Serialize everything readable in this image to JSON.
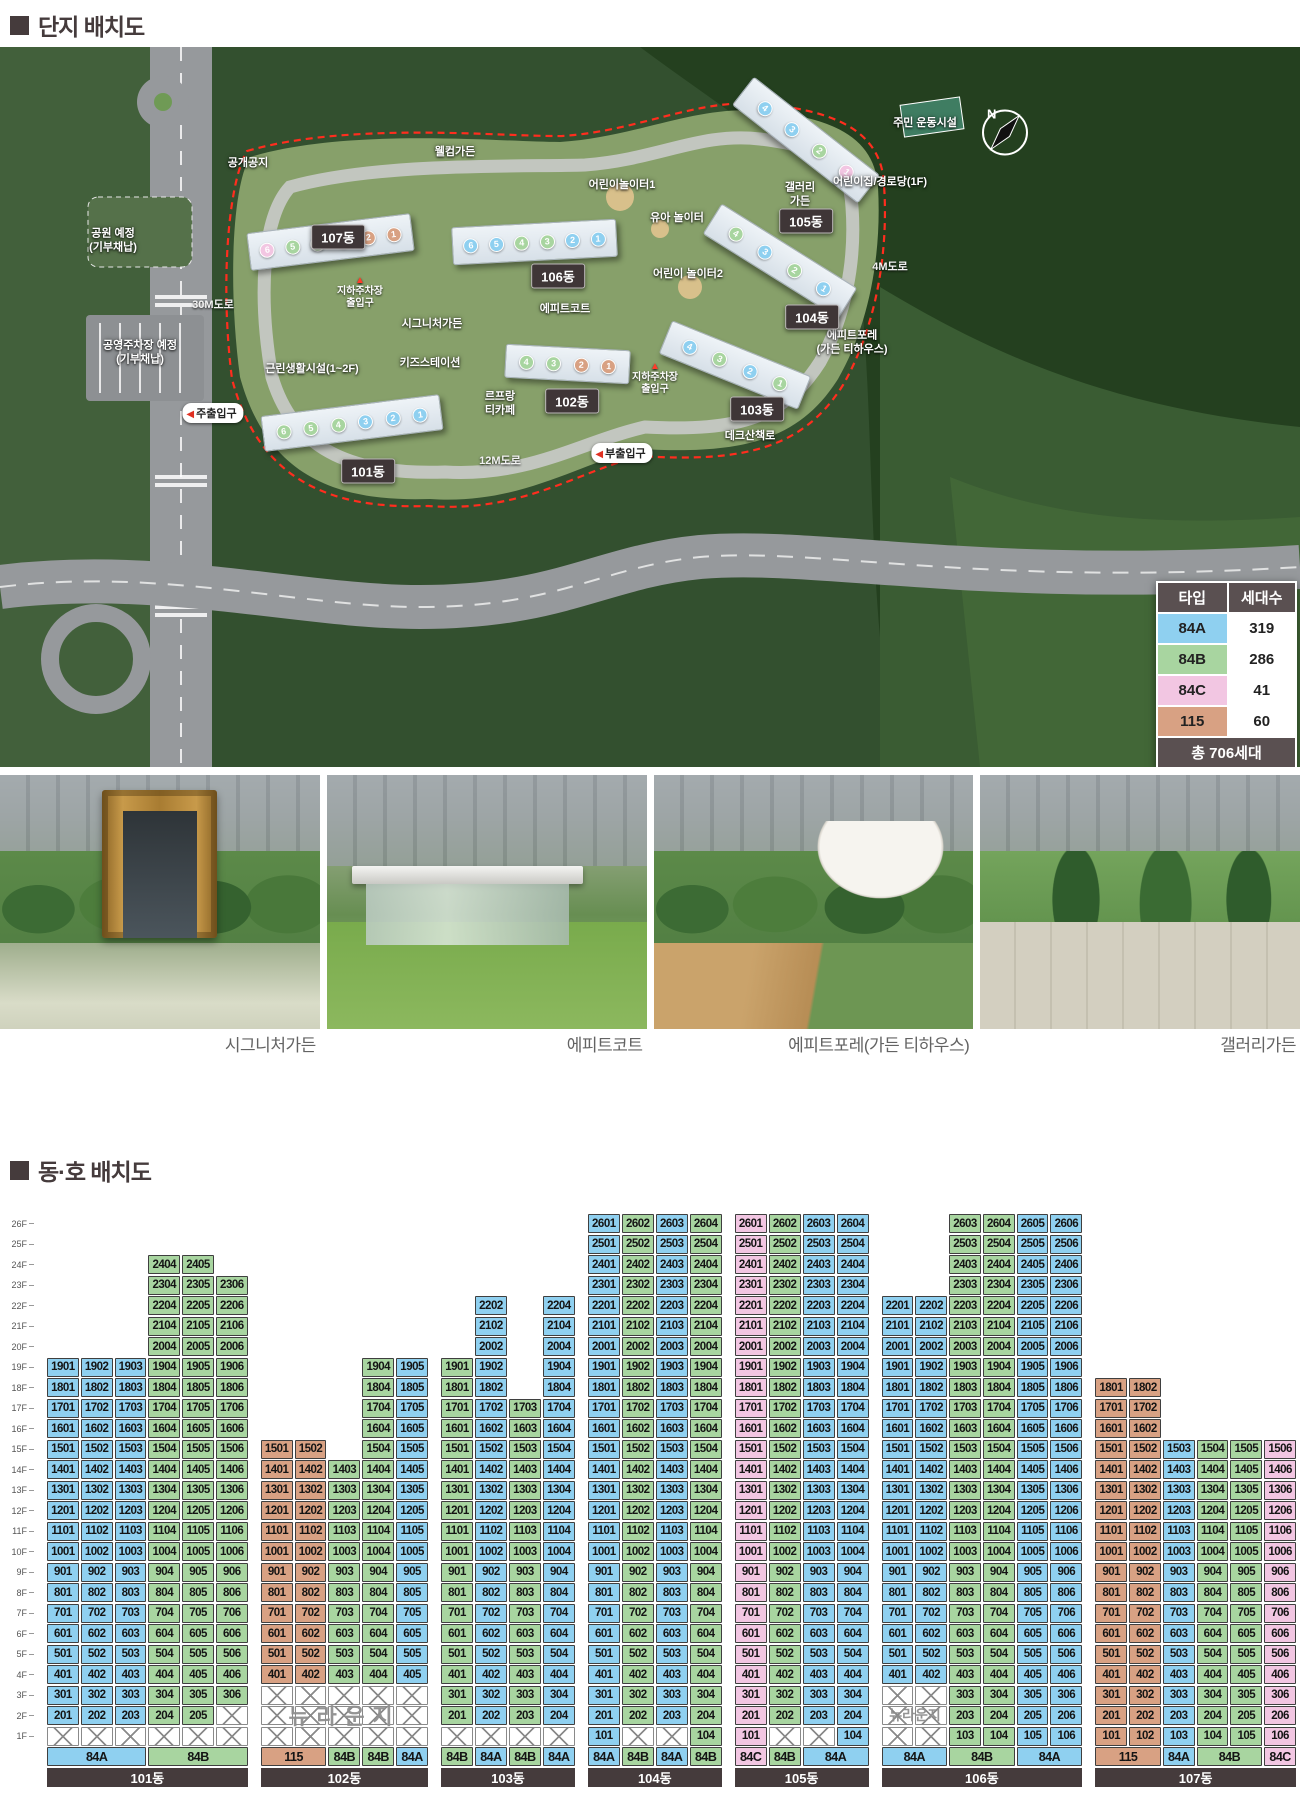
{
  "page": {
    "title_site": "단지 배치도",
    "title_units": "동·호 배치도"
  },
  "type_colors": {
    "84A": "#8fd0f0",
    "84B": "#a8d5a0",
    "84C": "#f2c6e2",
    "115": "#d8a183"
  },
  "legend": {
    "header": {
      "type": "타입",
      "count": "세대수"
    },
    "rows": [
      {
        "type": "84A",
        "count": "319"
      },
      {
        "type": "84B",
        "count": "286"
      },
      {
        "type": "84C",
        "count": "41"
      },
      {
        "type": "115",
        "count": "60"
      }
    ],
    "footer": "총 706세대"
  },
  "map": {
    "compass": "N",
    "badges": [
      {
        "text": "101동",
        "x": 368,
        "y": 424
      },
      {
        "text": "102동",
        "x": 572,
        "y": 354
      },
      {
        "text": "103동",
        "x": 757,
        "y": 362
      },
      {
        "text": "104동",
        "x": 812,
        "y": 270
      },
      {
        "text": "105동",
        "x": 806,
        "y": 174
      },
      {
        "text": "106동",
        "x": 558,
        "y": 229
      },
      {
        "text": "107동",
        "x": 338,
        "y": 190
      }
    ],
    "facilities": [
      {
        "text": "공개공지",
        "x": 248,
        "y": 117
      },
      {
        "text": "웰컴가든",
        "x": 455,
        "y": 106
      },
      {
        "text": "어린이놀이터1",
        "x": 622,
        "y": 139
      },
      {
        "text": "갤러리\n가든",
        "x": 800,
        "y": 148
      },
      {
        "text": "어린이집/경로당(1F)",
        "x": 880,
        "y": 136
      },
      {
        "text": "주민 운동시설",
        "x": 925,
        "y": 77
      },
      {
        "text": "유아 놀이터",
        "x": 677,
        "y": 172
      },
      {
        "text": "어린이 놀이터2",
        "x": 688,
        "y": 228
      },
      {
        "text": "시그니처가든",
        "x": 432,
        "y": 278
      },
      {
        "text": "에피트코트",
        "x": 565,
        "y": 263
      },
      {
        "text": "에피트포레\n(가든 티하우스)",
        "x": 852,
        "y": 296
      },
      {
        "text": "공원 예정\n(기부채납)",
        "x": 113,
        "y": 194
      },
      {
        "text": "공영주차장 예정\n(기부채납)",
        "x": 140,
        "y": 306
      },
      {
        "text": "근린생활시설(1~2F)",
        "x": 312,
        "y": 323
      },
      {
        "text": "키즈스테이션",
        "x": 430,
        "y": 317
      },
      {
        "text": "르프랑\n티카페",
        "x": 500,
        "y": 357
      },
      {
        "text": "데크산책로",
        "x": 750,
        "y": 390
      }
    ],
    "roads": [
      {
        "text": "30M도로",
        "x": 213,
        "y": 257
      },
      {
        "text": "4M도로",
        "x": 890,
        "y": 219
      },
      {
        "text": "12M도로",
        "x": 500,
        "y": 413
      }
    ],
    "entries": [
      {
        "text": "주출입구",
        "x": 213,
        "y": 366
      },
      {
        "text": "부출입구",
        "x": 622,
        "y": 406
      }
    ],
    "underground": [
      {
        "text": "지하주차장\n출입구",
        "x": 360,
        "y": 246
      },
      {
        "text": "지하주차장\n출입구",
        "x": 655,
        "y": 332
      }
    ],
    "buildings": [
      {
        "name": "101동",
        "x": 262,
        "y": 358,
        "w": 180,
        "h": 36,
        "rot": -7,
        "units": [
          {
            "n": 6,
            "t": "84B"
          },
          {
            "n": 5,
            "t": "84B"
          },
          {
            "n": 4,
            "t": "84B"
          },
          {
            "n": 3,
            "t": "84A"
          },
          {
            "n": 2,
            "t": "84A"
          },
          {
            "n": 1,
            "t": "84A"
          }
        ]
      },
      {
        "name": "102동",
        "x": 505,
        "y": 300,
        "w": 125,
        "h": 34,
        "rot": 3,
        "units": [
          {
            "n": 4,
            "t": "84B"
          },
          {
            "n": 3,
            "t": "84B"
          },
          {
            "n": 2,
            "t": "115"
          },
          {
            "n": 1,
            "t": "115"
          }
        ]
      },
      {
        "name": "103동",
        "x": 660,
        "y": 300,
        "w": 150,
        "h": 36,
        "rot": 22,
        "units": [
          {
            "n": 4,
            "t": "84A"
          },
          {
            "n": 3,
            "t": "84B"
          },
          {
            "n": 2,
            "t": "84A"
          },
          {
            "n": 1,
            "t": "84B"
          }
        ]
      },
      {
        "name": "104동",
        "x": 700,
        "y": 196,
        "w": 160,
        "h": 36,
        "rot": 32,
        "units": [
          {
            "n": 4,
            "t": "84B"
          },
          {
            "n": 3,
            "t": "84A"
          },
          {
            "n": 2,
            "t": "84B"
          },
          {
            "n": 1,
            "t": "84A"
          }
        ]
      },
      {
        "name": "105동",
        "x": 726,
        "y": 75,
        "w": 160,
        "h": 36,
        "rot": 38,
        "units": [
          {
            "n": 4,
            "t": "84A"
          },
          {
            "n": 3,
            "t": "84A"
          },
          {
            "n": 2,
            "t": "84B"
          },
          {
            "n": 1,
            "t": "84C"
          }
        ]
      },
      {
        "name": "106동",
        "x": 452,
        "y": 176,
        "w": 165,
        "h": 38,
        "rot": -3,
        "units": [
          {
            "n": 6,
            "t": "84A"
          },
          {
            "n": 5,
            "t": "84A"
          },
          {
            "n": 4,
            "t": "84B"
          },
          {
            "n": 3,
            "t": "84B"
          },
          {
            "n": 2,
            "t": "84A"
          },
          {
            "n": 1,
            "t": "84A"
          }
        ]
      },
      {
        "name": "107동",
        "x": 248,
        "y": 176,
        "w": 165,
        "h": 38,
        "rot": -7,
        "units": [
          {
            "n": 6,
            "t": "84C"
          },
          {
            "n": 5,
            "t": "84B"
          },
          {
            "n": 4,
            "t": "84B"
          },
          {
            "n": 3,
            "t": "84A"
          },
          {
            "n": 2,
            "t": "115"
          },
          {
            "n": 1,
            "t": "115"
          }
        ]
      }
    ]
  },
  "photos": [
    {
      "caption": "시그니처가든"
    },
    {
      "caption": "에피트코트"
    },
    {
      "caption": "에피트포레(가든 티하우스)"
    },
    {
      "caption": "갤러리가든"
    }
  ],
  "grid": {
    "floor_labels": [
      "26F",
      "25F",
      "24F",
      "23F",
      "22F",
      "21F",
      "20F",
      "19F",
      "18F",
      "17F",
      "16F",
      "15F",
      "14F",
      "13F",
      "12F",
      "11F",
      "10F",
      "9F",
      "8F",
      "7F",
      "6F",
      "5F",
      "4F",
      "3F",
      "2F",
      "1F"
    ],
    "watermark_text": "뉴라운지",
    "buildings": [
      {
        "name": "101동",
        "columns": [
          {
            "u": 1,
            "type": "84A",
            "from": 2,
            "to": 19
          },
          {
            "u": 2,
            "type": "84A",
            "from": 2,
            "to": 19
          },
          {
            "u": 3,
            "type": "84A",
            "from": 2,
            "to": 19
          },
          {
            "u": 4,
            "type": "84B",
            "from": 2,
            "to": 24
          },
          {
            "u": 5,
            "type": "84B",
            "from": 2,
            "to": 24
          },
          {
            "u": 6,
            "type": "84B",
            "from": 3,
            "to": 23
          }
        ],
        "hatch": [
          [
            1,
            1
          ],
          [
            2,
            1
          ],
          [
            3,
            1
          ],
          [
            4,
            1
          ],
          [
            5,
            1
          ],
          [
            6,
            1
          ],
          [
            6,
            2
          ]
        ],
        "types": [
          {
            "label": "84A",
            "type": "84A",
            "span": 3
          },
          {
            "label": "84B",
            "type": "84B",
            "span": 3
          }
        ]
      },
      {
        "name": "102동",
        "columns": [
          {
            "u": 1,
            "type": "115",
            "from": 4,
            "to": 15
          },
          {
            "u": 2,
            "type": "115",
            "from": 4,
            "to": 15
          },
          {
            "u": 3,
            "type": "84B",
            "from": 4,
            "to": 14
          },
          {
            "u": 4,
            "type": "84B",
            "from": 4,
            "to": 19
          },
          {
            "u": 5,
            "type": "84A",
            "from": 4,
            "to": 19
          }
        ],
        "hatch": [
          [
            1,
            1
          ],
          [
            2,
            1
          ],
          [
            3,
            1
          ],
          [
            4,
            1
          ],
          [
            5,
            1
          ],
          [
            1,
            2
          ],
          [
            2,
            2
          ],
          [
            3,
            2
          ],
          [
            4,
            2
          ],
          [
            5,
            2
          ],
          [
            1,
            3
          ],
          [
            2,
            3
          ],
          [
            3,
            3
          ],
          [
            4,
            3
          ],
          [
            5,
            3
          ]
        ],
        "watermark": {
          "col_start": 1,
          "col_span": 5
        },
        "types": [
          {
            "label": "115",
            "type": "115",
            "span": 2
          },
          {
            "label": "84B",
            "type": "84B",
            "span": 1
          },
          {
            "label": "84B",
            "type": "84B",
            "span": 1
          },
          {
            "label": "84A",
            "type": "84A",
            "span": 1
          }
        ]
      },
      {
        "name": "103동",
        "columns": [
          {
            "u": 1,
            "type": "84B",
            "from": 2,
            "to": 19
          },
          {
            "u": 2,
            "type": "84A",
            "from": 2,
            "to": 22
          },
          {
            "u": 3,
            "type": "84B",
            "from": 2,
            "to": 17
          },
          {
            "u": 4,
            "type": "84A",
            "from": 2,
            "to": 22
          }
        ],
        "hatch": [
          [
            1,
            1
          ],
          [
            2,
            1
          ],
          [
            3,
            1
          ],
          [
            4,
            1
          ]
        ],
        "types": [
          {
            "label": "84B",
            "type": "84B",
            "span": 1
          },
          {
            "label": "84A",
            "type": "84A",
            "span": 1
          },
          {
            "label": "84B",
            "type": "84B",
            "span": 1
          },
          {
            "label": "84A",
            "type": "84A",
            "span": 1
          }
        ]
      },
      {
        "name": "104동",
        "columns": [
          {
            "u": 1,
            "type": "84A",
            "from": 1,
            "to": 26
          },
          {
            "u": 2,
            "type": "84B",
            "from": 2,
            "to": 26
          },
          {
            "u": 3,
            "type": "84A",
            "from": 2,
            "to": 26
          },
          {
            "u": 4,
            "type": "84B",
            "from": 1,
            "to": 26
          }
        ],
        "hatch": [
          [
            2,
            1
          ],
          [
            3,
            1
          ]
        ],
        "types": [
          {
            "label": "84A",
            "type": "84A",
            "span": 1
          },
          {
            "label": "84B",
            "type": "84B",
            "span": 1
          },
          {
            "label": "84A",
            "type": "84A",
            "span": 1
          },
          {
            "label": "84B",
            "type": "84B",
            "span": 1
          }
        ]
      },
      {
        "name": "105동",
        "columns": [
          {
            "u": 1,
            "type": "84C",
            "from": 1,
            "to": 26
          },
          {
            "u": 2,
            "type": "84B",
            "from": 2,
            "to": 26
          },
          {
            "u": 3,
            "type": "84A",
            "from": 2,
            "to": 26
          },
          {
            "u": 4,
            "type": "84A",
            "from": 1,
            "to": 26
          }
        ],
        "hatch": [
          [
            2,
            1
          ],
          [
            3,
            1
          ]
        ],
        "types": [
          {
            "label": "84C",
            "type": "84C",
            "span": 1
          },
          {
            "label": "84B",
            "type": "84B",
            "span": 1
          },
          {
            "label": "84A",
            "type": "84A",
            "span": 2
          }
        ]
      },
      {
        "name": "106동",
        "columns": [
          {
            "u": 1,
            "type": "84A",
            "from": 4,
            "to": 22
          },
          {
            "u": 2,
            "type": "84A",
            "from": 4,
            "to": 22
          },
          {
            "u": 3,
            "type": "84B",
            "from": 1,
            "to": 26
          },
          {
            "u": 4,
            "type": "84B",
            "from": 1,
            "to": 26
          },
          {
            "u": 5,
            "type": "84A",
            "from": 1,
            "to": 26
          },
          {
            "u": 6,
            "type": "84A",
            "from": 1,
            "to": 26
          }
        ],
        "hatch": [
          [
            1,
            1
          ],
          [
            2,
            1
          ],
          [
            1,
            2
          ],
          [
            2,
            2
          ],
          [
            1,
            3
          ],
          [
            2,
            3
          ]
        ],
        "watermark": {
          "col_start": 1,
          "col_span": 2
        },
        "types": [
          {
            "label": "84A",
            "type": "84A",
            "span": 2
          },
          {
            "label": "84B",
            "type": "84B",
            "span": 2
          },
          {
            "label": "84A",
            "type": "84A",
            "span": 2
          }
        ]
      },
      {
        "name": "107동",
        "columns": [
          {
            "u": 1,
            "type": "115",
            "from": 1,
            "to": 18
          },
          {
            "u": 2,
            "type": "115",
            "from": 1,
            "to": 18
          },
          {
            "u": 3,
            "type": "84A",
            "from": 1,
            "to": 15
          },
          {
            "u": 4,
            "type": "84B",
            "from": 1,
            "to": 15
          },
          {
            "u": 5,
            "type": "84B",
            "from": 1,
            "to": 15
          },
          {
            "u": 6,
            "type": "84C",
            "from": 1,
            "to": 15
          }
        ],
        "hatch": [],
        "types": [
          {
            "label": "115",
            "type": "115",
            "span": 2
          },
          {
            "label": "84A",
            "type": "84A",
            "span": 1
          },
          {
            "label": "84B",
            "type": "84B",
            "span": 2
          },
          {
            "label": "84C",
            "type": "84C",
            "span": 1
          }
        ]
      }
    ]
  }
}
